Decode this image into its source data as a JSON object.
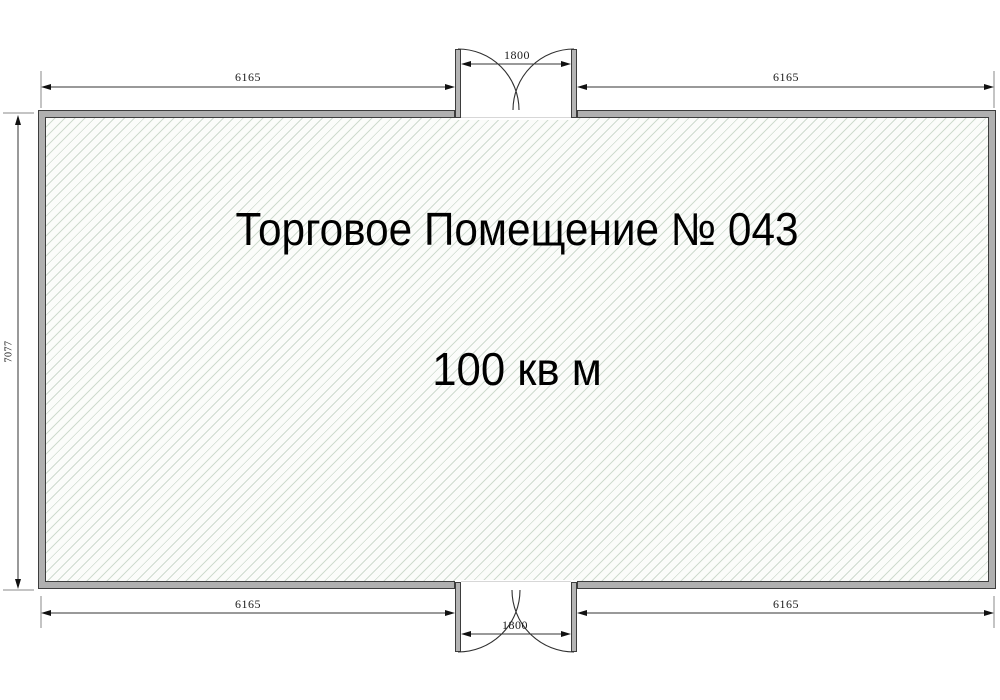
{
  "plan": {
    "title": "Торговое Помещение № 043",
    "area": "100 кв м",
    "dimensions": {
      "top_left": "6165",
      "top_right": "6165",
      "top_door": "1800",
      "bottom_left": "6165",
      "bottom_right": "6165",
      "bottom_door": "1800",
      "left_height": "7077"
    },
    "colors": {
      "wall_fill": "#b0b0b0",
      "wall_outline": "#3d3d3d",
      "hatch_line": "#cfdbcf",
      "hatch_background": "#fbfcfa",
      "dimension_line": "#333333",
      "extension_line": "#8a8a8a",
      "text": "#000000"
    }
  }
}
